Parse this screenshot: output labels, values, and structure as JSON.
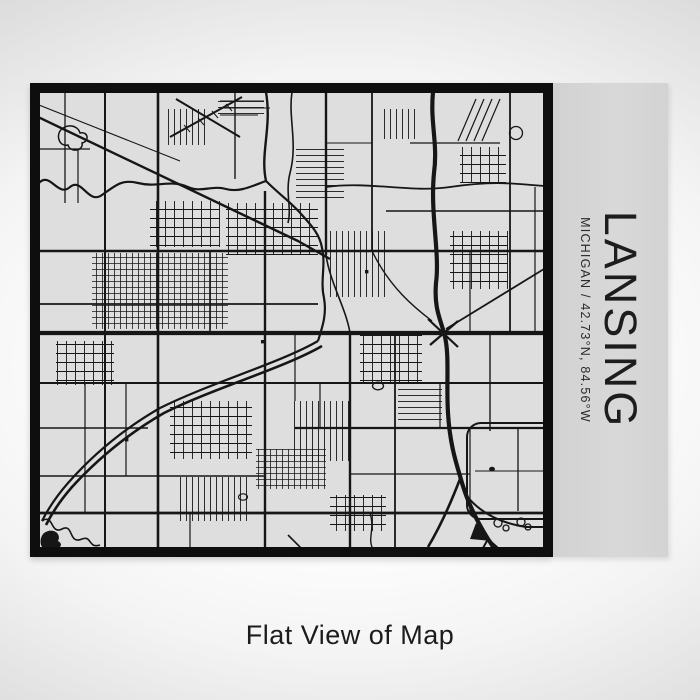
{
  "print": {
    "city": "LANSING",
    "location_line": "MICHIGAN / 42.73°N, 84.56°W",
    "map_alt": "Street map of Lansing, Michigan in black on light gray",
    "colors": {
      "frame": "#0e0e0e",
      "map_background": "#dedede",
      "roads": "#161616",
      "side_panel": "#d6d6d6"
    }
  },
  "caption": {
    "text": "Flat View of Map"
  }
}
